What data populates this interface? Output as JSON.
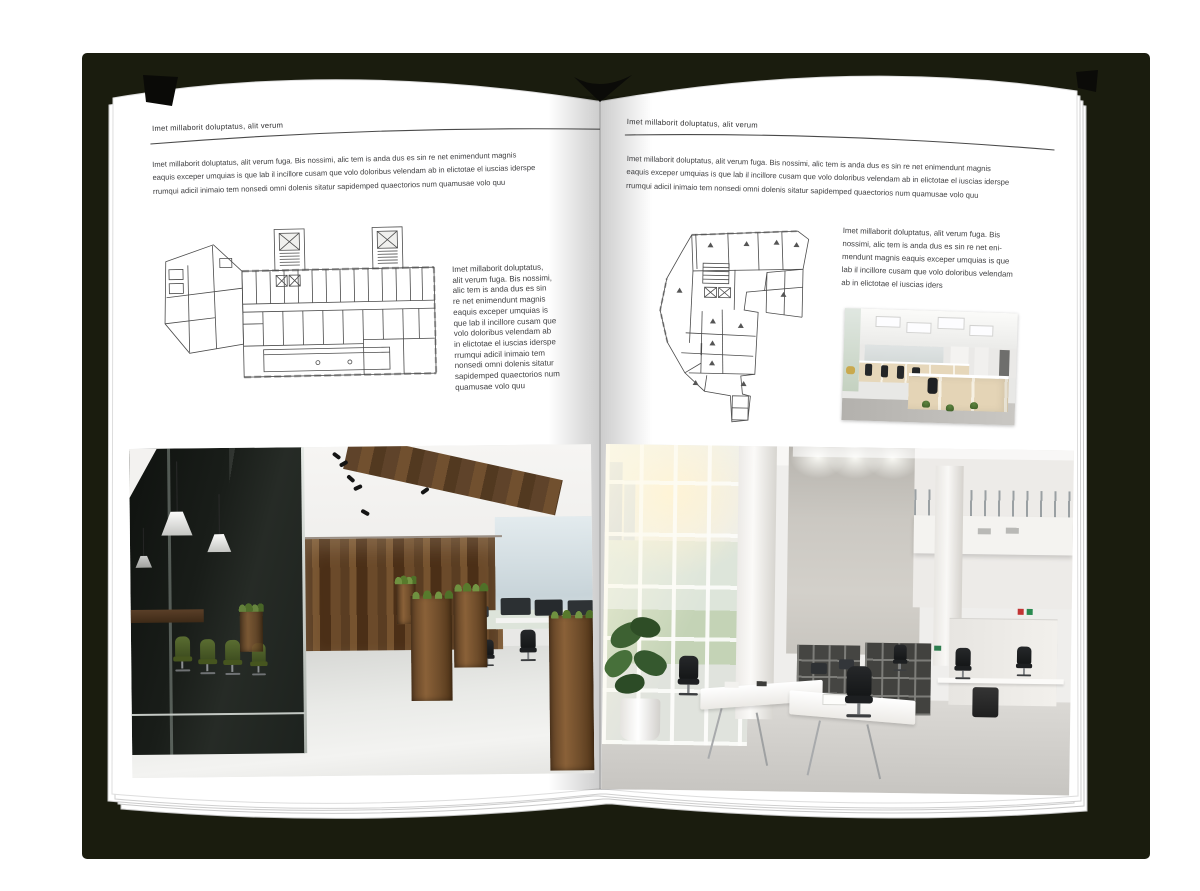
{
  "book": {
    "left_page": {
      "header": "Imet millaborit doluptatus, alit verum",
      "intro": "Imet millaborit doluptatus, alit verum fuga. Bis nossimi, alic tem is anda dus es sin re net enimendunt magnis\neaquis exceper umquias is que lab il incillore cusam que volo doloribus velendam ab in elictotae el iuscias iderspe\nrrumqui adicil inimaio tem nonsedi omni dolenis sitatur sapidemped quaectorios num quamusae volo quu",
      "side_text": "Imet millaborit doluptatus,\nalit verum fuga. Bis nossimi,\nalic tem is anda dus es sin\nre net enimendunt magnis\neaquis exceper umquias is\nque lab il incillore cusam que\nvolo doloribus velendam ab\nin elictotae el iuscias iderspe\nrrumqui adicil inimaio tem\nnonsedi omni dolenis sitatur\nsapidemped quaectorios num\nquamusae volo quu"
    },
    "right_page": {
      "header": "Imet millaborit doluptatus, alit verum",
      "intro": "Imet millaborit doluptatus, alit verum fuga. Bis nossimi, alic tem is anda dus es sin re net enimendunt magnis\neaquis exceper umquias is que lab il incillore cusam que volo doloribus velendam ab in elictotae el iuscias iderspe\nrrumqui adicil inimaio tem nonsedi omni dolenis sitatur sapidemped quaectorios num quamusae volo quu",
      "side_text": "Imet millaborit doluptatus, alit verum fuga. Bis\nnossimi, alic tem is anda dus es sin re net eni-\nmendunt magnis eaquis exceper umquias is que\nlab il incillore cusam que volo doloribus velendam\nab in elictotae el iuscias iders"
    }
  },
  "colors": {
    "cover": "#1a1c0e",
    "page": "#ffffff",
    "text": "#3f3f41",
    "rule": "#4a4a4a",
    "plan_lines": "#4b4b4b",
    "wood_accent": "#6e4c2a",
    "plant_green": "#587a2c"
  }
}
